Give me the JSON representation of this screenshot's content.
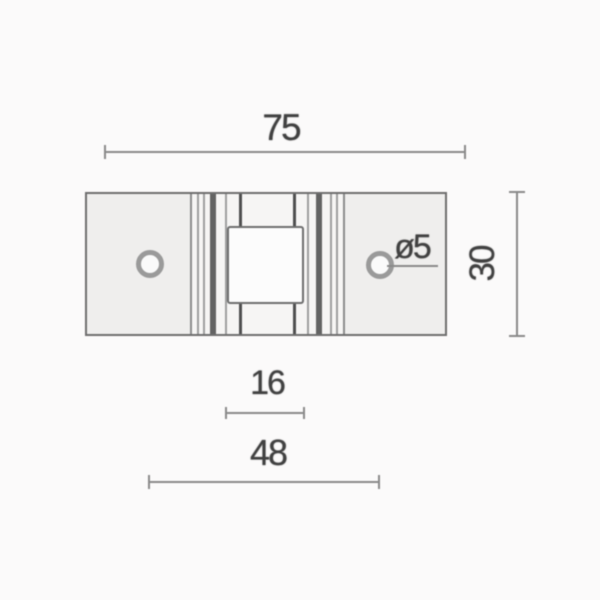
{
  "dimensions": {
    "overall_width": "75",
    "overall_height": "30",
    "hole_diameter": "ø5",
    "center_square": "16",
    "hole_spacing": "48"
  },
  "colors": {
    "background": "#fbfafa",
    "part_fill": "#efeeed",
    "ridge_fill": "#f6f5f4",
    "outline": "#6e6e6e",
    "ridge_line": "#9e9e9e",
    "ridge_band": "#636363",
    "channel_line": "#4f4f4f",
    "dimension_line": "#8a8a8a",
    "hole_ring": "#9a9a9a",
    "square_fill": "#fcfcfc",
    "text": "#414141"
  }
}
